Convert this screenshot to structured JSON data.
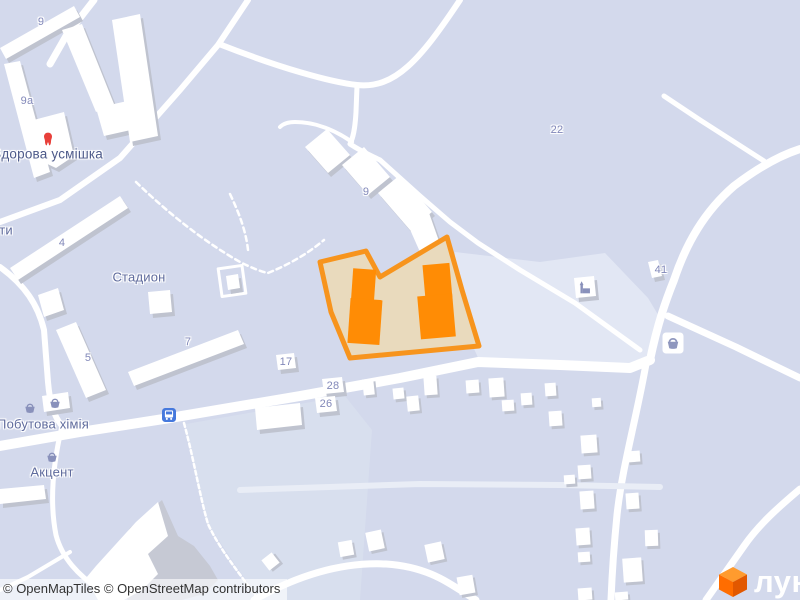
{
  "map": {
    "attribution": {
      "full": "© OpenMapTiles © OpenStreetMap contributors",
      "parts": [
        "© OpenMapTiles",
        "© OpenStreetMap contributors"
      ]
    },
    "logo": {
      "text": "лун"
    },
    "labels": {
      "house_numbers": [
        {
          "t": "9",
          "x": 41,
          "y": 22
        },
        {
          "t": "9а",
          "x": 27,
          "y": 101
        },
        {
          "t": "4",
          "x": 62,
          "y": 243
        },
        {
          "t": "5",
          "x": 88,
          "y": 358
        },
        {
          "t": "7",
          "x": 188,
          "y": 342
        },
        {
          "t": "9",
          "x": 366,
          "y": 192
        },
        {
          "t": "17",
          "x": 286,
          "y": 362
        },
        {
          "t": "28",
          "x": 333,
          "y": 386
        },
        {
          "t": "26",
          "x": 326,
          "y": 404
        },
        {
          "t": "22",
          "x": 557,
          "y": 130
        },
        {
          "t": "41",
          "x": 661,
          "y": 270
        }
      ],
      "places": [
        {
          "t": "Стадион",
          "x": 139,
          "y": 277
        },
        {
          "t": "Здорова усмішка",
          "x": 48,
          "y": 154,
          "v": "poi"
        },
        {
          "t": "Побутова хімія",
          "x": 43,
          "y": 424
        },
        {
          "t": "Акцент",
          "x": 52,
          "y": 472
        },
        {
          "t": "ти",
          "x": 6,
          "y": 230
        }
      ]
    },
    "icons": [
      {
        "name": "dentist-tooth-icon",
        "sym": "tooth",
        "x": 48,
        "y": 139,
        "size": 16
      },
      {
        "name": "shop-basket-icon",
        "sym": "basket",
        "x": 30,
        "y": 408,
        "size": 15
      },
      {
        "name": "shop-basket-icon",
        "sym": "basket",
        "x": 55,
        "y": 403,
        "size": 15
      },
      {
        "name": "shop-basket-icon",
        "sym": "basket",
        "x": 52,
        "y": 457,
        "size": 15
      },
      {
        "name": "shop-basket-boxed-icon",
        "sym": "basketbox",
        "x": 673,
        "y": 343,
        "size": 21
      },
      {
        "name": "church-icon",
        "sym": "church",
        "x": 585,
        "y": 288,
        "size": 17
      },
      {
        "name": "bus-stop-icon",
        "sym": "bus",
        "x": 169,
        "y": 415,
        "size": 14
      }
    ],
    "colors": {
      "background": "#d3d9ec",
      "light_landuse": "#e2e7f4",
      "road": "#ffffff",
      "building": "#ffffff",
      "building_shadow": "#bfc3cf",
      "parcel_fill": "#e9dabd",
      "parcel_border": "#f7941d",
      "highlight_building": "#ff8c05",
      "label_number": "#8288b9",
      "label_place": "#5f6b9d",
      "poi_icon": "#8991bb",
      "tooth_red": "#e8403a",
      "bus_blue": "#4679dd",
      "logo_orange": "#ff6d00"
    }
  }
}
